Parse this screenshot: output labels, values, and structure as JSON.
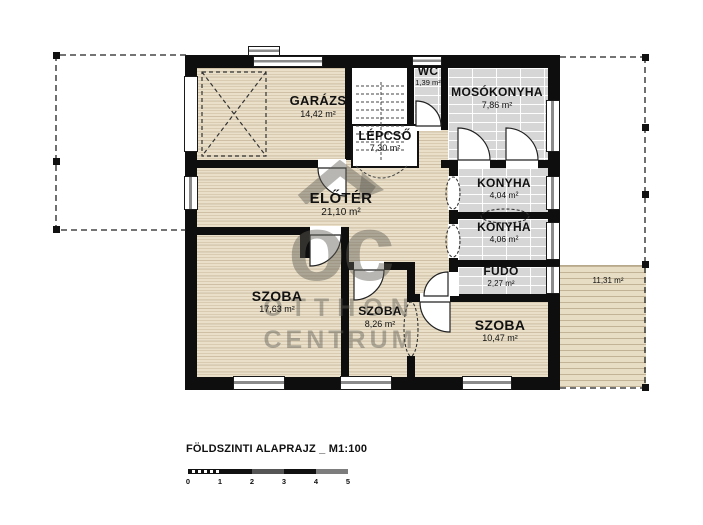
{
  "plan": {
    "title": "FÖLDSZINTI ALAPRAJZ _ M1:100",
    "scale_ticks": [
      "0",
      "1",
      "2",
      "3",
      "4",
      "5"
    ],
    "watermark": {
      "monogram": "oc",
      "line1": "OTTHON",
      "line2": "CENTRUM"
    },
    "colors": {
      "wall": "#0e0e0e",
      "wood": "#eae0ca",
      "tile": "#d6d6d6",
      "terrace": "#e7ddc4"
    }
  },
  "rooms": {
    "garazs": {
      "name": "GARÁZS",
      "area": "14,42 m²"
    },
    "wc": {
      "name": "WC",
      "area": "1,39 m²"
    },
    "mosokonyha": {
      "name": "MOSÓKONYHA",
      "area": "7,86 m²"
    },
    "lepcso": {
      "name": "LÉPCSŐ",
      "area": "7,30 m²"
    },
    "eloter": {
      "name": "ELŐTÉR",
      "area": "21,10 m²"
    },
    "konyha_1": {
      "name": "KONYHA",
      "area": "4,04 m²"
    },
    "konyha_2": {
      "name": "KONYHA",
      "area": "4,06 m²"
    },
    "fudo": {
      "name": "FÜDŐ",
      "area": "2,27 m²"
    },
    "szoba_1": {
      "name": "SZOBA",
      "area": "17,63 m²"
    },
    "szoba_2": {
      "name": "SZOBA",
      "area": "8,26 m²"
    },
    "szoba_3": {
      "name": "SZOBA",
      "area": "10,47 m²"
    },
    "terasz": {
      "area": "11,31 m²"
    }
  }
}
